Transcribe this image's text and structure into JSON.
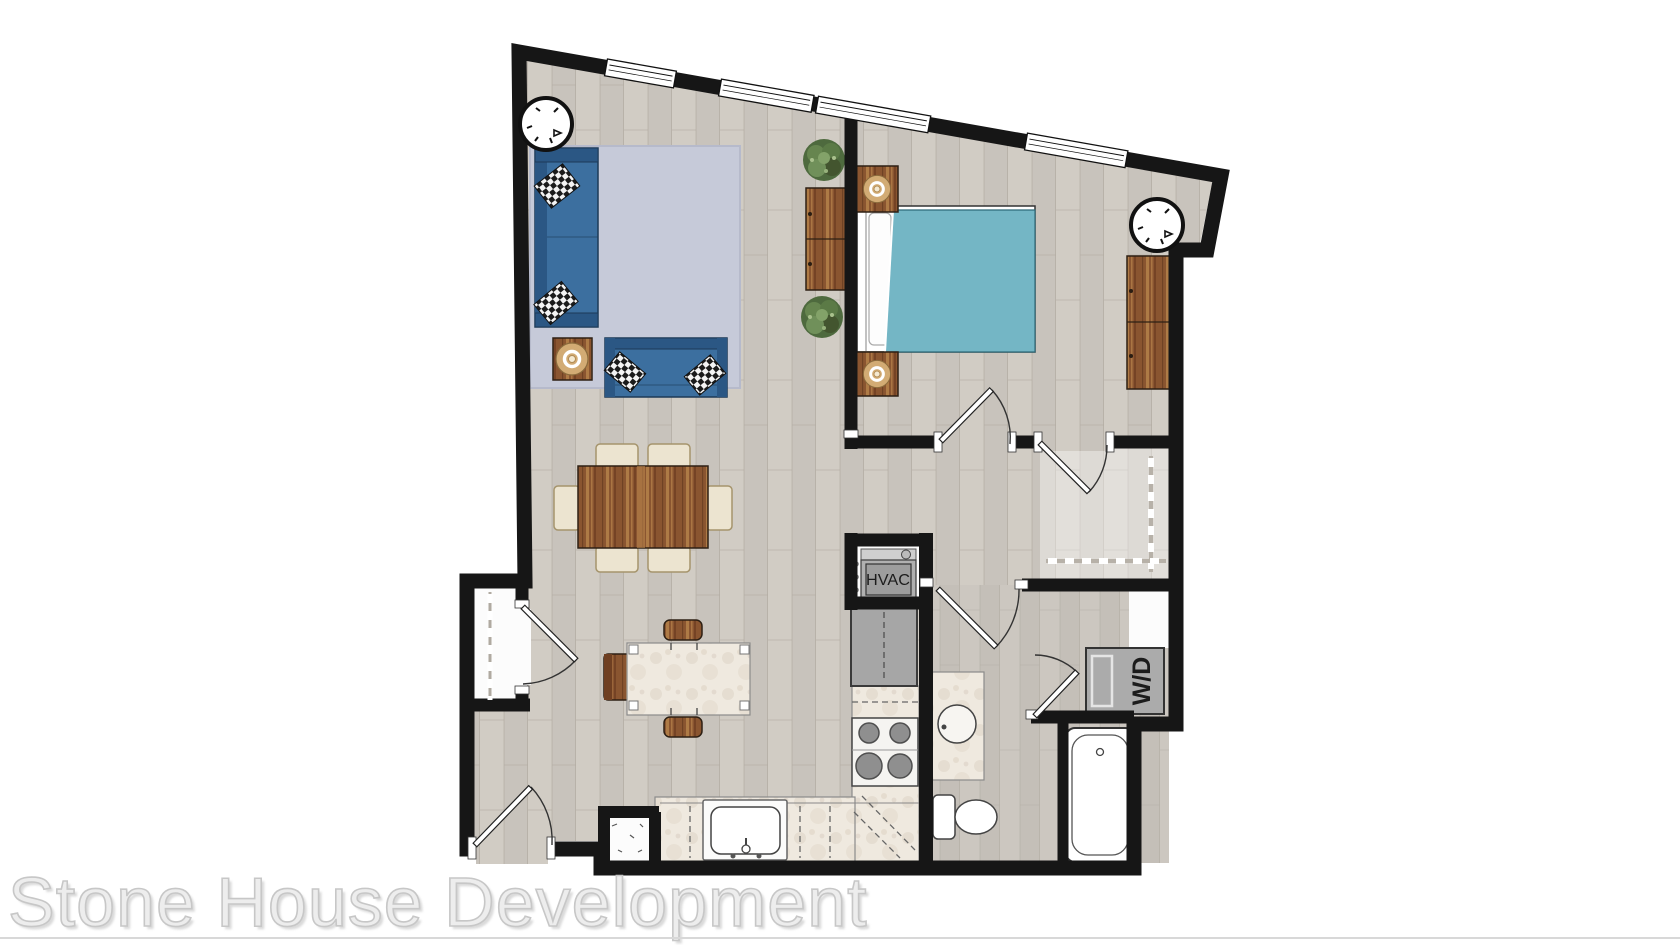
{
  "watermark": {
    "text": "Stone House Development"
  },
  "labels": {
    "hvac": "HVAC",
    "washer_dryer": "W/D"
  },
  "colors": {
    "wall": "#161616",
    "floor_wood": "#d1ccc4",
    "floor_wood_line": "#b3aca1",
    "floor_bath": "#ccc7c0",
    "closet_white": "#fcfcfc",
    "rug_blue": "#c6cad9",
    "sofa_blue": "#3c6f9f",
    "sofa_blue_dark": "#2b5784",
    "bed_teal": "#74b6c5",
    "wood_brown": "#8a5530",
    "wood_brown_light": "#b4814a",
    "chair_cream": "#ece4d0",
    "marble_white": "#efe9df",
    "counter_line": "#6e6e6e",
    "appliance_gray": "#a6a6a6",
    "appliance_dark": "#3a3a3a",
    "lamp_tan": "#d2ab74",
    "plant_green": "#4e6a3e",
    "watermark_gray": "#c7c7c7",
    "line_gray": "#d8d8d8"
  }
}
